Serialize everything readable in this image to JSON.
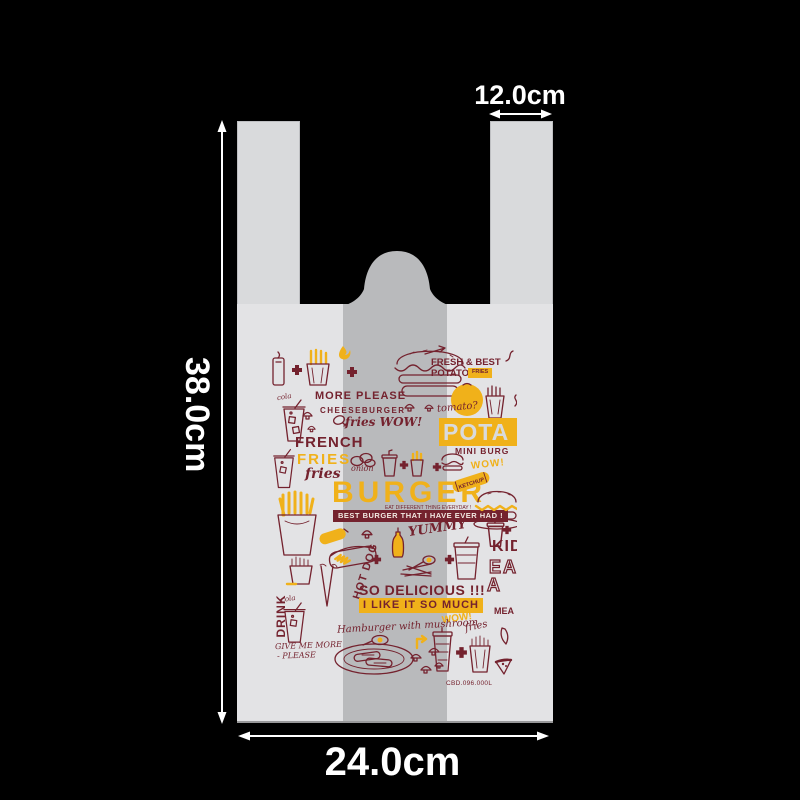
{
  "page": {
    "background": "#000000"
  },
  "dimensions": {
    "height": "38.0cm",
    "width": "24.0cm",
    "handle": "12.0cm"
  },
  "bag": {
    "colors": {
      "background": "#000000",
      "handle": "#d9dadc",
      "body": "#e3e3e5",
      "gusset": "#b9babc",
      "print_maroon": "#74222e",
      "print_yellow": "#f0b11a",
      "banner_text": "#f2e9e2",
      "label_color": "#ffffff",
      "arrow": "#ffffff"
    }
  },
  "print": {
    "texts": {
      "more_please": "MORE PLEASE",
      "cheeseburger": "CHEESEBURGER",
      "fries_wow": "fries WOW!",
      "french": "FRENCH",
      "fries_caps": "FRIES",
      "fries_script": "fries",
      "burger": "BURGER",
      "eat_different": "EAT DIFFERENT THING EVERYDAY !",
      "best_banner": "BEST BURGER THAT I HAVE EVER HAD !",
      "fresh_best": "FRESH & BEST",
      "potato": "POTATO",
      "potato_chip": "FRIES",
      "tomato": "tomato?",
      "pota": "POTA",
      "mini_burger": "MINI BURG",
      "wow_1": "WOW!",
      "kid": "KID",
      "ea": "EA",
      "ea_2": "A",
      "meal": "MEA",
      "yummy": "YUMMY",
      "hot_dog": "HOT DOG",
      "so_delicious": "SO DELICIOUS !!!",
      "i_like_it": "I LIKE IT SO MUCH",
      "wow_2": "WOW!",
      "hamburger_mushroom": "Hamburger with mushroom",
      "fries_script_2": "fries",
      "drink": "DRINK",
      "give_me_more": "GIVE ME MORE",
      "please": "- PLEASE",
      "onion": "onion",
      "cola_1": "cola",
      "cola_2": "cola",
      "ketchup": "KETCHUP",
      "code": "CBD.096.000L"
    }
  }
}
